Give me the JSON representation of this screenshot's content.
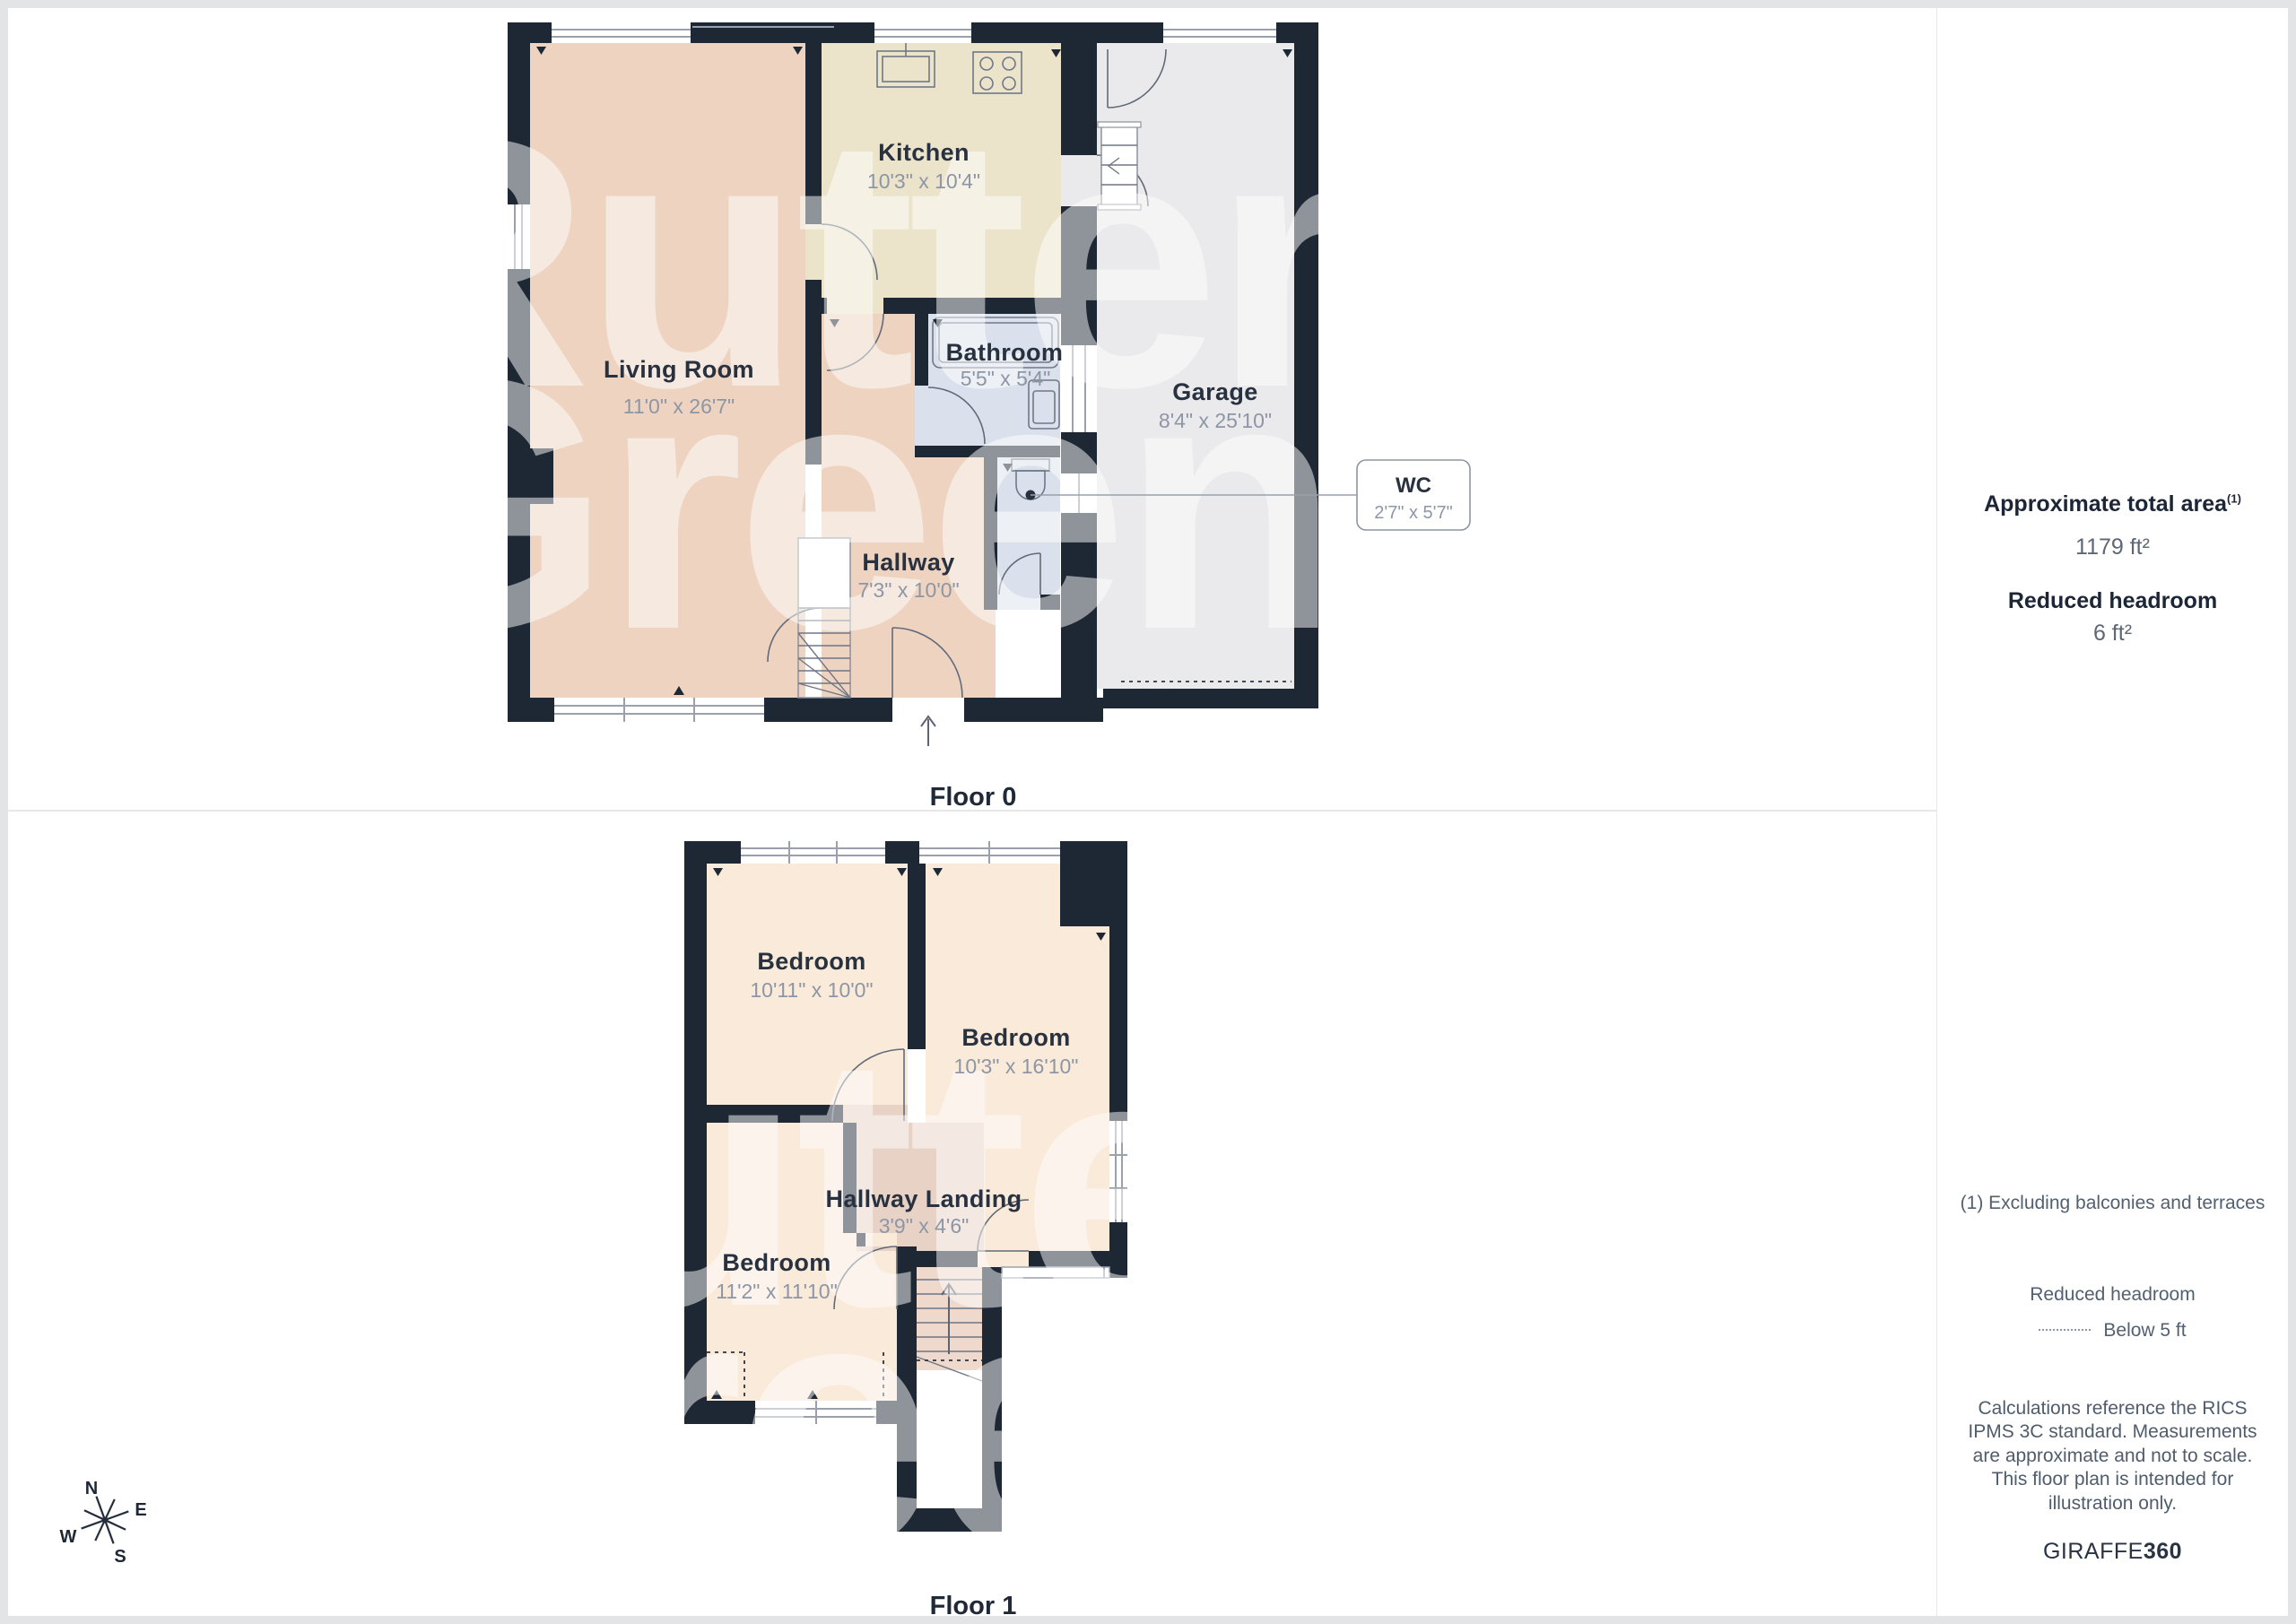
{
  "page": {
    "floor0_label": "Floor 0",
    "floor1_label": "Floor 1"
  },
  "watermark": {
    "line1": "Rutter",
    "line2": "Green"
  },
  "floor0": {
    "living": {
      "name": "Living Room",
      "dims": "11'0\" x 26'7\""
    },
    "kitchen": {
      "name": "Kitchen",
      "dims": "10'3\" x 10'4\""
    },
    "bathroom": {
      "name": "Bathroom",
      "dims": "5'5\" x 5'4\""
    },
    "hallway": {
      "name": "Hallway",
      "dims": "7'3\" x 10'0\""
    },
    "garage": {
      "name": "Garage",
      "dims": "8'4\" x 25'10\""
    },
    "wc": {
      "name": "WC",
      "dims": "2'7\" x 5'7\""
    }
  },
  "floor1": {
    "bedroom1": {
      "name": "Bedroom",
      "dims": "10'11\" x 10'0\""
    },
    "bedroom2": {
      "name": "Bedroom",
      "dims": "10'3\" x 16'10\""
    },
    "bedroom3": {
      "name": "Bedroom",
      "dims": "11'2\" x 11'10\""
    },
    "landing": {
      "name": "Hallway Landing",
      "dims": "3'9\" x 4'6\""
    }
  },
  "compass": {
    "north": "N",
    "east": "E",
    "south": "S",
    "west": "W"
  },
  "sidebar": {
    "total_area_label": "Approximate total area",
    "total_area_superscript": "(1)",
    "total_area_value": "1179 ft²",
    "reduced_headroom_label": "Reduced headroom",
    "reduced_headroom_value": "6 ft²",
    "footnote": "(1) Excluding balconies and terraces",
    "legend_title": "Reduced headroom",
    "legend_item": "Below 5 ft",
    "disclaimer": "Calculations reference the RICS IPMS 3C standard. Measurements are approximate and not to scale. This floor plan is intended for illustration only.",
    "brand_name": "GIRAFFE",
    "brand_suffix": "360"
  },
  "colors": {
    "wall": "#1e2734",
    "living_fill": "#edd3c0",
    "kitchen_fill": "#ebe4cb",
    "bathroom_fill": "#dbe1ec",
    "garage_fill": "#eaeaec",
    "bedroom_fill": "#faead9",
    "landing_fill": "#e8d2c6",
    "stairs_fill": "#eed9cc",
    "room_name_text": "#28313f",
    "room_dim_text": "#8d96a6"
  }
}
